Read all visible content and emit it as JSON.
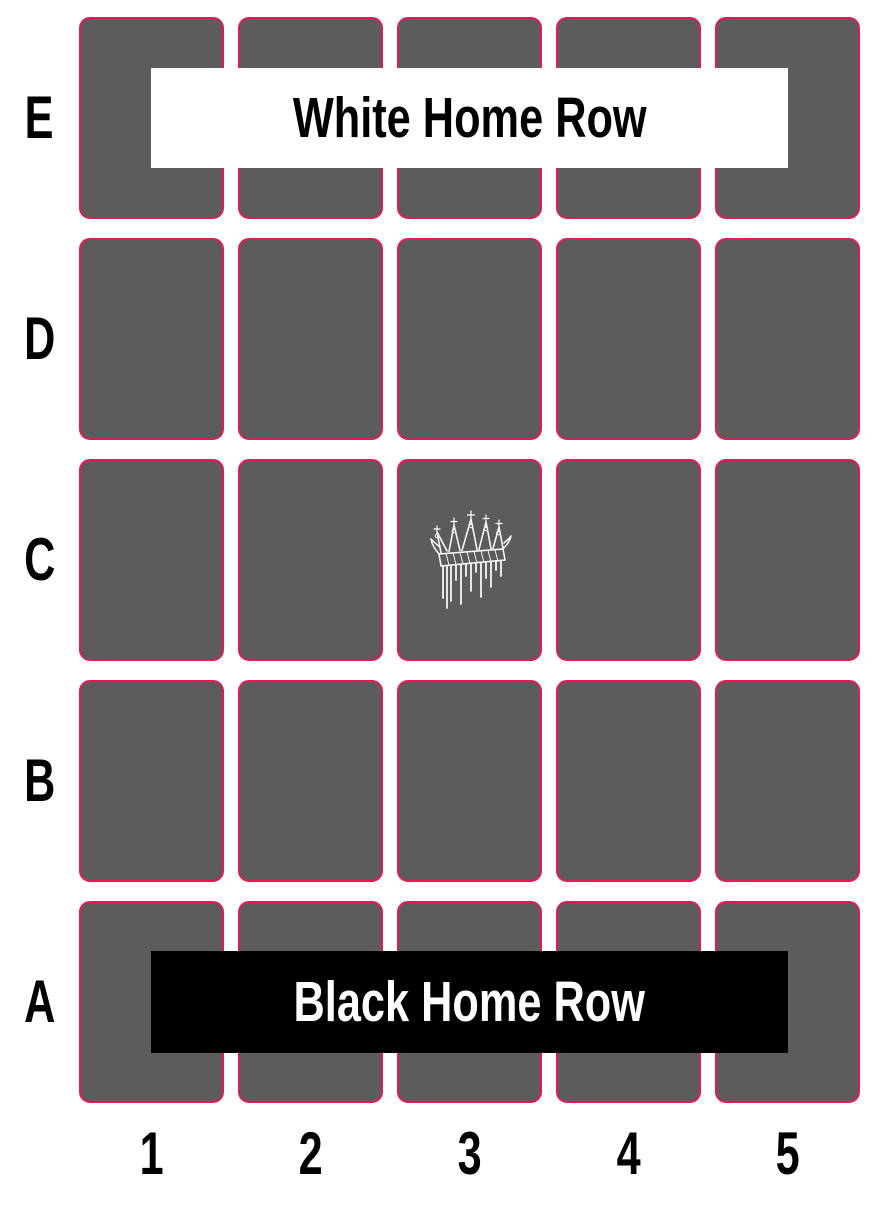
{
  "board": {
    "title": "5x5 game board",
    "row_labels": [
      "E",
      "D",
      "C",
      "B",
      "A"
    ],
    "column_labels": [
      "1",
      "2",
      "3",
      "4",
      "5"
    ],
    "rows": 5,
    "cols": 5,
    "banners": [
      {
        "id": "white-home-row",
        "label": "White Home Row",
        "row": "E"
      },
      {
        "id": "black-home-row",
        "label": "Black Home Row",
        "row": "A"
      }
    ],
    "pieces": [
      {
        "name": "crown-icon",
        "description": "white dripping crown",
        "cell": "C3",
        "color": "#ffffff"
      }
    ],
    "colors": {
      "background": "#ffffff",
      "cell_fill": "#5c5c5c",
      "cell_border": "#e41a52",
      "white_banner_bg": "#ffffff",
      "white_banner_text": "#000000",
      "black_banner_bg": "#000000",
      "black_banner_text": "#ffffff",
      "label_text": "#000000"
    }
  }
}
